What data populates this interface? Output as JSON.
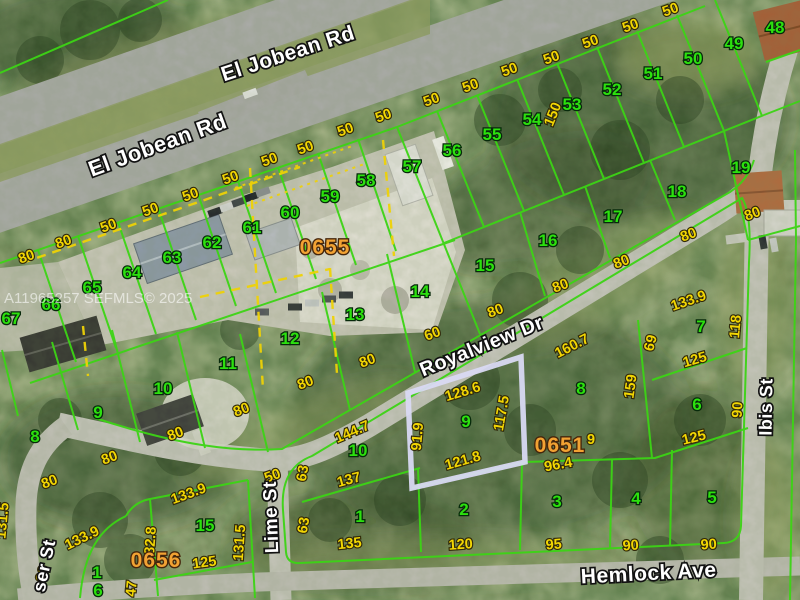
{
  "map": {
    "watermark": "A11965257 SEFMLS© 2025",
    "streets": [
      {
        "t": "El Jobean Rd",
        "x": 160,
        "y": 152,
        "r": -20,
        "size": 22
      },
      {
        "t": "El Jobean Rd",
        "x": 290,
        "y": 60,
        "r": -18,
        "size": 21
      },
      {
        "t": "Royalview Dr",
        "x": 484,
        "y": 352,
        "r": -22,
        "size": 20
      },
      {
        "t": "Lime St",
        "x": 277,
        "y": 517,
        "r": -92,
        "size": 19
      },
      {
        "t": "Hemlock Ave",
        "x": 649,
        "y": 580,
        "r": -3,
        "size": 21
      },
      {
        "t": "Ibis St",
        "x": 772,
        "y": 407,
        "r": -89,
        "size": 18
      },
      {
        "t": "ser St",
        "x": 50,
        "y": 567,
        "r": -78,
        "size": 18
      }
    ],
    "plat_numbers": [
      {
        "t": "0655",
        "x": 325,
        "y": 254
      },
      {
        "t": "0651",
        "x": 560,
        "y": 452
      },
      {
        "t": "0656",
        "x": 156,
        "y": 567
      }
    ],
    "lot_numbers": [
      {
        "t": "48",
        "x": 775,
        "y": 33
      },
      {
        "t": "49",
        "x": 734,
        "y": 49
      },
      {
        "t": "50",
        "x": 693,
        "y": 64
      },
      {
        "t": "51",
        "x": 653,
        "y": 79
      },
      {
        "t": "52",
        "x": 612,
        "y": 95
      },
      {
        "t": "53",
        "x": 572,
        "y": 110
      },
      {
        "t": "54",
        "x": 532,
        "y": 125
      },
      {
        "t": "55",
        "x": 492,
        "y": 140
      },
      {
        "t": "56",
        "x": 452,
        "y": 156
      },
      {
        "t": "57",
        "x": 412,
        "y": 172
      },
      {
        "t": "58",
        "x": 366,
        "y": 186
      },
      {
        "t": "59",
        "x": 330,
        "y": 202
      },
      {
        "t": "60",
        "x": 290,
        "y": 218
      },
      {
        "t": "61",
        "x": 252,
        "y": 233
      },
      {
        "t": "62",
        "x": 212,
        "y": 248
      },
      {
        "t": "63",
        "x": 172,
        "y": 263
      },
      {
        "t": "64",
        "x": 132,
        "y": 278
      },
      {
        "t": "65",
        "x": 92,
        "y": 293
      },
      {
        "t": "66",
        "x": 51,
        "y": 310
      },
      {
        "t": "67",
        "x": 11,
        "y": 324
      },
      {
        "t": "19",
        "x": 741,
        "y": 173
      },
      {
        "t": "18",
        "x": 677,
        "y": 197
      },
      {
        "t": "17",
        "x": 613,
        "y": 222
      },
      {
        "t": "16",
        "x": 548,
        "y": 246
      },
      {
        "t": "15",
        "x": 485,
        "y": 271
      },
      {
        "t": "14",
        "x": 420,
        "y": 297
      },
      {
        "t": "13",
        "x": 355,
        "y": 320
      },
      {
        "t": "12",
        "x": 290,
        "y": 344
      },
      {
        "t": "11",
        "x": 228,
        "y": 369
      },
      {
        "t": "10",
        "x": 163,
        "y": 394
      },
      {
        "t": "9",
        "x": 98,
        "y": 418
      },
      {
        "t": "8",
        "x": 35,
        "y": 442
      },
      {
        "t": "9",
        "x": 466,
        "y": 427
      },
      {
        "t": "8",
        "x": 581,
        "y": 394
      },
      {
        "t": "7",
        "x": 701,
        "y": 332
      },
      {
        "t": "6",
        "x": 697,
        "y": 410
      },
      {
        "t": "10",
        "x": 358,
        "y": 456
      },
      {
        "t": "1",
        "x": 360,
        "y": 522
      },
      {
        "t": "2",
        "x": 464,
        "y": 515
      },
      {
        "t": "3",
        "x": 557,
        "y": 507
      },
      {
        "t": "4",
        "x": 636,
        "y": 504
      },
      {
        "t": "5",
        "x": 712,
        "y": 503
      },
      {
        "t": "15",
        "x": 205,
        "y": 531
      },
      {
        "t": "1",
        "x": 97,
        "y": 578
      },
      {
        "t": "6",
        "x": 98,
        "y": 596
      }
    ],
    "dimensions": [
      {
        "t": "50",
        "x": 232,
        "y": 182,
        "r": -20
      },
      {
        "t": "50",
        "x": 271,
        "y": 164,
        "r": -20
      },
      {
        "t": "50",
        "x": 307,
        "y": 152,
        "r": -20
      },
      {
        "t": "50",
        "x": 347,
        "y": 134,
        "r": -20
      },
      {
        "t": "50",
        "x": 385,
        "y": 120,
        "r": -20
      },
      {
        "t": "50",
        "x": 433,
        "y": 104,
        "r": -20
      },
      {
        "t": "50",
        "x": 472,
        "y": 90,
        "r": -20
      },
      {
        "t": "50",
        "x": 511,
        "y": 74,
        "r": -20
      },
      {
        "t": "50",
        "x": 553,
        "y": 62,
        "r": -20
      },
      {
        "t": "50",
        "x": 592,
        "y": 46,
        "r": -20
      },
      {
        "t": "50",
        "x": 632,
        "y": 30,
        "r": -20
      },
      {
        "t": "50",
        "x": 672,
        "y": 14,
        "r": -20
      },
      {
        "t": "50",
        "x": 192,
        "y": 199,
        "r": -20
      },
      {
        "t": "50",
        "x": 152,
        "y": 214,
        "r": -20
      },
      {
        "t": "50",
        "x": 110,
        "y": 230,
        "r": -20
      },
      {
        "t": "80",
        "x": 65,
        "y": 246,
        "r": -20
      },
      {
        "t": "80",
        "x": 28,
        "y": 261,
        "r": -20
      },
      {
        "t": "150",
        "x": 557,
        "y": 116,
        "r": -68
      },
      {
        "t": "80",
        "x": 754,
        "y": 218,
        "r": -21
      },
      {
        "t": "80",
        "x": 690,
        "y": 239,
        "r": -21
      },
      {
        "t": "80",
        "x": 623,
        "y": 266,
        "r": -21
      },
      {
        "t": "80",
        "x": 562,
        "y": 290,
        "r": -21
      },
      {
        "t": "80",
        "x": 497,
        "y": 315,
        "r": -21
      },
      {
        "t": "60",
        "x": 434,
        "y": 338,
        "r": -21
      },
      {
        "t": "80",
        "x": 369,
        "y": 365,
        "r": -21
      },
      {
        "t": "80",
        "x": 307,
        "y": 387,
        "r": -21
      },
      {
        "t": "80",
        "x": 243,
        "y": 414,
        "r": -21
      },
      {
        "t": "80",
        "x": 177,
        "y": 438,
        "r": -21
      },
      {
        "t": "80",
        "x": 111,
        "y": 462,
        "r": -21
      },
      {
        "t": "80",
        "x": 51,
        "y": 486,
        "r": -21
      },
      {
        "t": "128.6",
        "x": 464,
        "y": 396,
        "r": -17
      },
      {
        "t": "117.5",
        "x": 506,
        "y": 414,
        "r": -80
      },
      {
        "t": "91.9",
        "x": 422,
        "y": 437,
        "r": -85
      },
      {
        "t": "121.8",
        "x": 464,
        "y": 465,
        "r": -16
      },
      {
        "t": "160.7",
        "x": 574,
        "y": 350,
        "r": -27
      },
      {
        "t": "133.9",
        "x": 690,
        "y": 305,
        "r": -19
      },
      {
        "t": "69",
        "x": 655,
        "y": 344,
        "r": -76
      },
      {
        "t": "118",
        "x": 740,
        "y": 327,
        "r": -85
      },
      {
        "t": "125",
        "x": 696,
        "y": 364,
        "r": -16
      },
      {
        "t": "159",
        "x": 635,
        "y": 387,
        "r": -82
      },
      {
        "t": "90",
        "x": 742,
        "y": 410,
        "r": -87
      },
      {
        "t": "125",
        "x": 695,
        "y": 442,
        "r": -14
      },
      {
        "t": "9",
        "x": 591,
        "y": 444,
        "r": 0
      },
      {
        "t": "96.4",
        "x": 559,
        "y": 469,
        "r": -10
      },
      {
        "t": "144.7",
        "x": 354,
        "y": 436,
        "r": -23
      },
      {
        "t": "137",
        "x": 350,
        "y": 484,
        "r": -15
      },
      {
        "t": "63",
        "x": 307,
        "y": 474,
        "r": -80
      },
      {
        "t": "63",
        "x": 308,
        "y": 526,
        "r": -80
      },
      {
        "t": "50",
        "x": 274,
        "y": 480,
        "r": -20
      },
      {
        "t": "135",
        "x": 350,
        "y": 548,
        "r": -6
      },
      {
        "t": "120",
        "x": 461,
        "y": 549,
        "r": -4
      },
      {
        "t": "95",
        "x": 554,
        "y": 549,
        "r": -4
      },
      {
        "t": "90",
        "x": 631,
        "y": 550,
        "r": -4
      },
      {
        "t": "90",
        "x": 709,
        "y": 549,
        "r": -4
      },
      {
        "t": "133.9",
        "x": 190,
        "y": 498,
        "r": -20
      },
      {
        "t": "133.9",
        "x": 84,
        "y": 542,
        "r": -26
      },
      {
        "t": "131.5",
        "x": 244,
        "y": 543,
        "r": -86
      },
      {
        "t": "82.8",
        "x": 155,
        "y": 541,
        "r": -86
      },
      {
        "t": "125",
        "x": 205,
        "y": 567,
        "r": -8
      },
      {
        "t": "47",
        "x": 136,
        "y": 589,
        "r": -85
      },
      {
        "t": "99",
        "x": 47,
        "y": 575,
        "r": -74
      },
      {
        "t": "131.5",
        "x": 7,
        "y": 521,
        "r": -85
      }
    ],
    "colors": {
      "lot_number_green": "#2ce10e",
      "dimension_yellow": "#f2d603",
      "plat_orange": "#f2a233",
      "parcel_line_green": "#3cd415",
      "overlay_dash_yellow": "#eed206",
      "highlight_lavender": "#d9d9f3",
      "street_label_white": "#ffffff"
    }
  }
}
